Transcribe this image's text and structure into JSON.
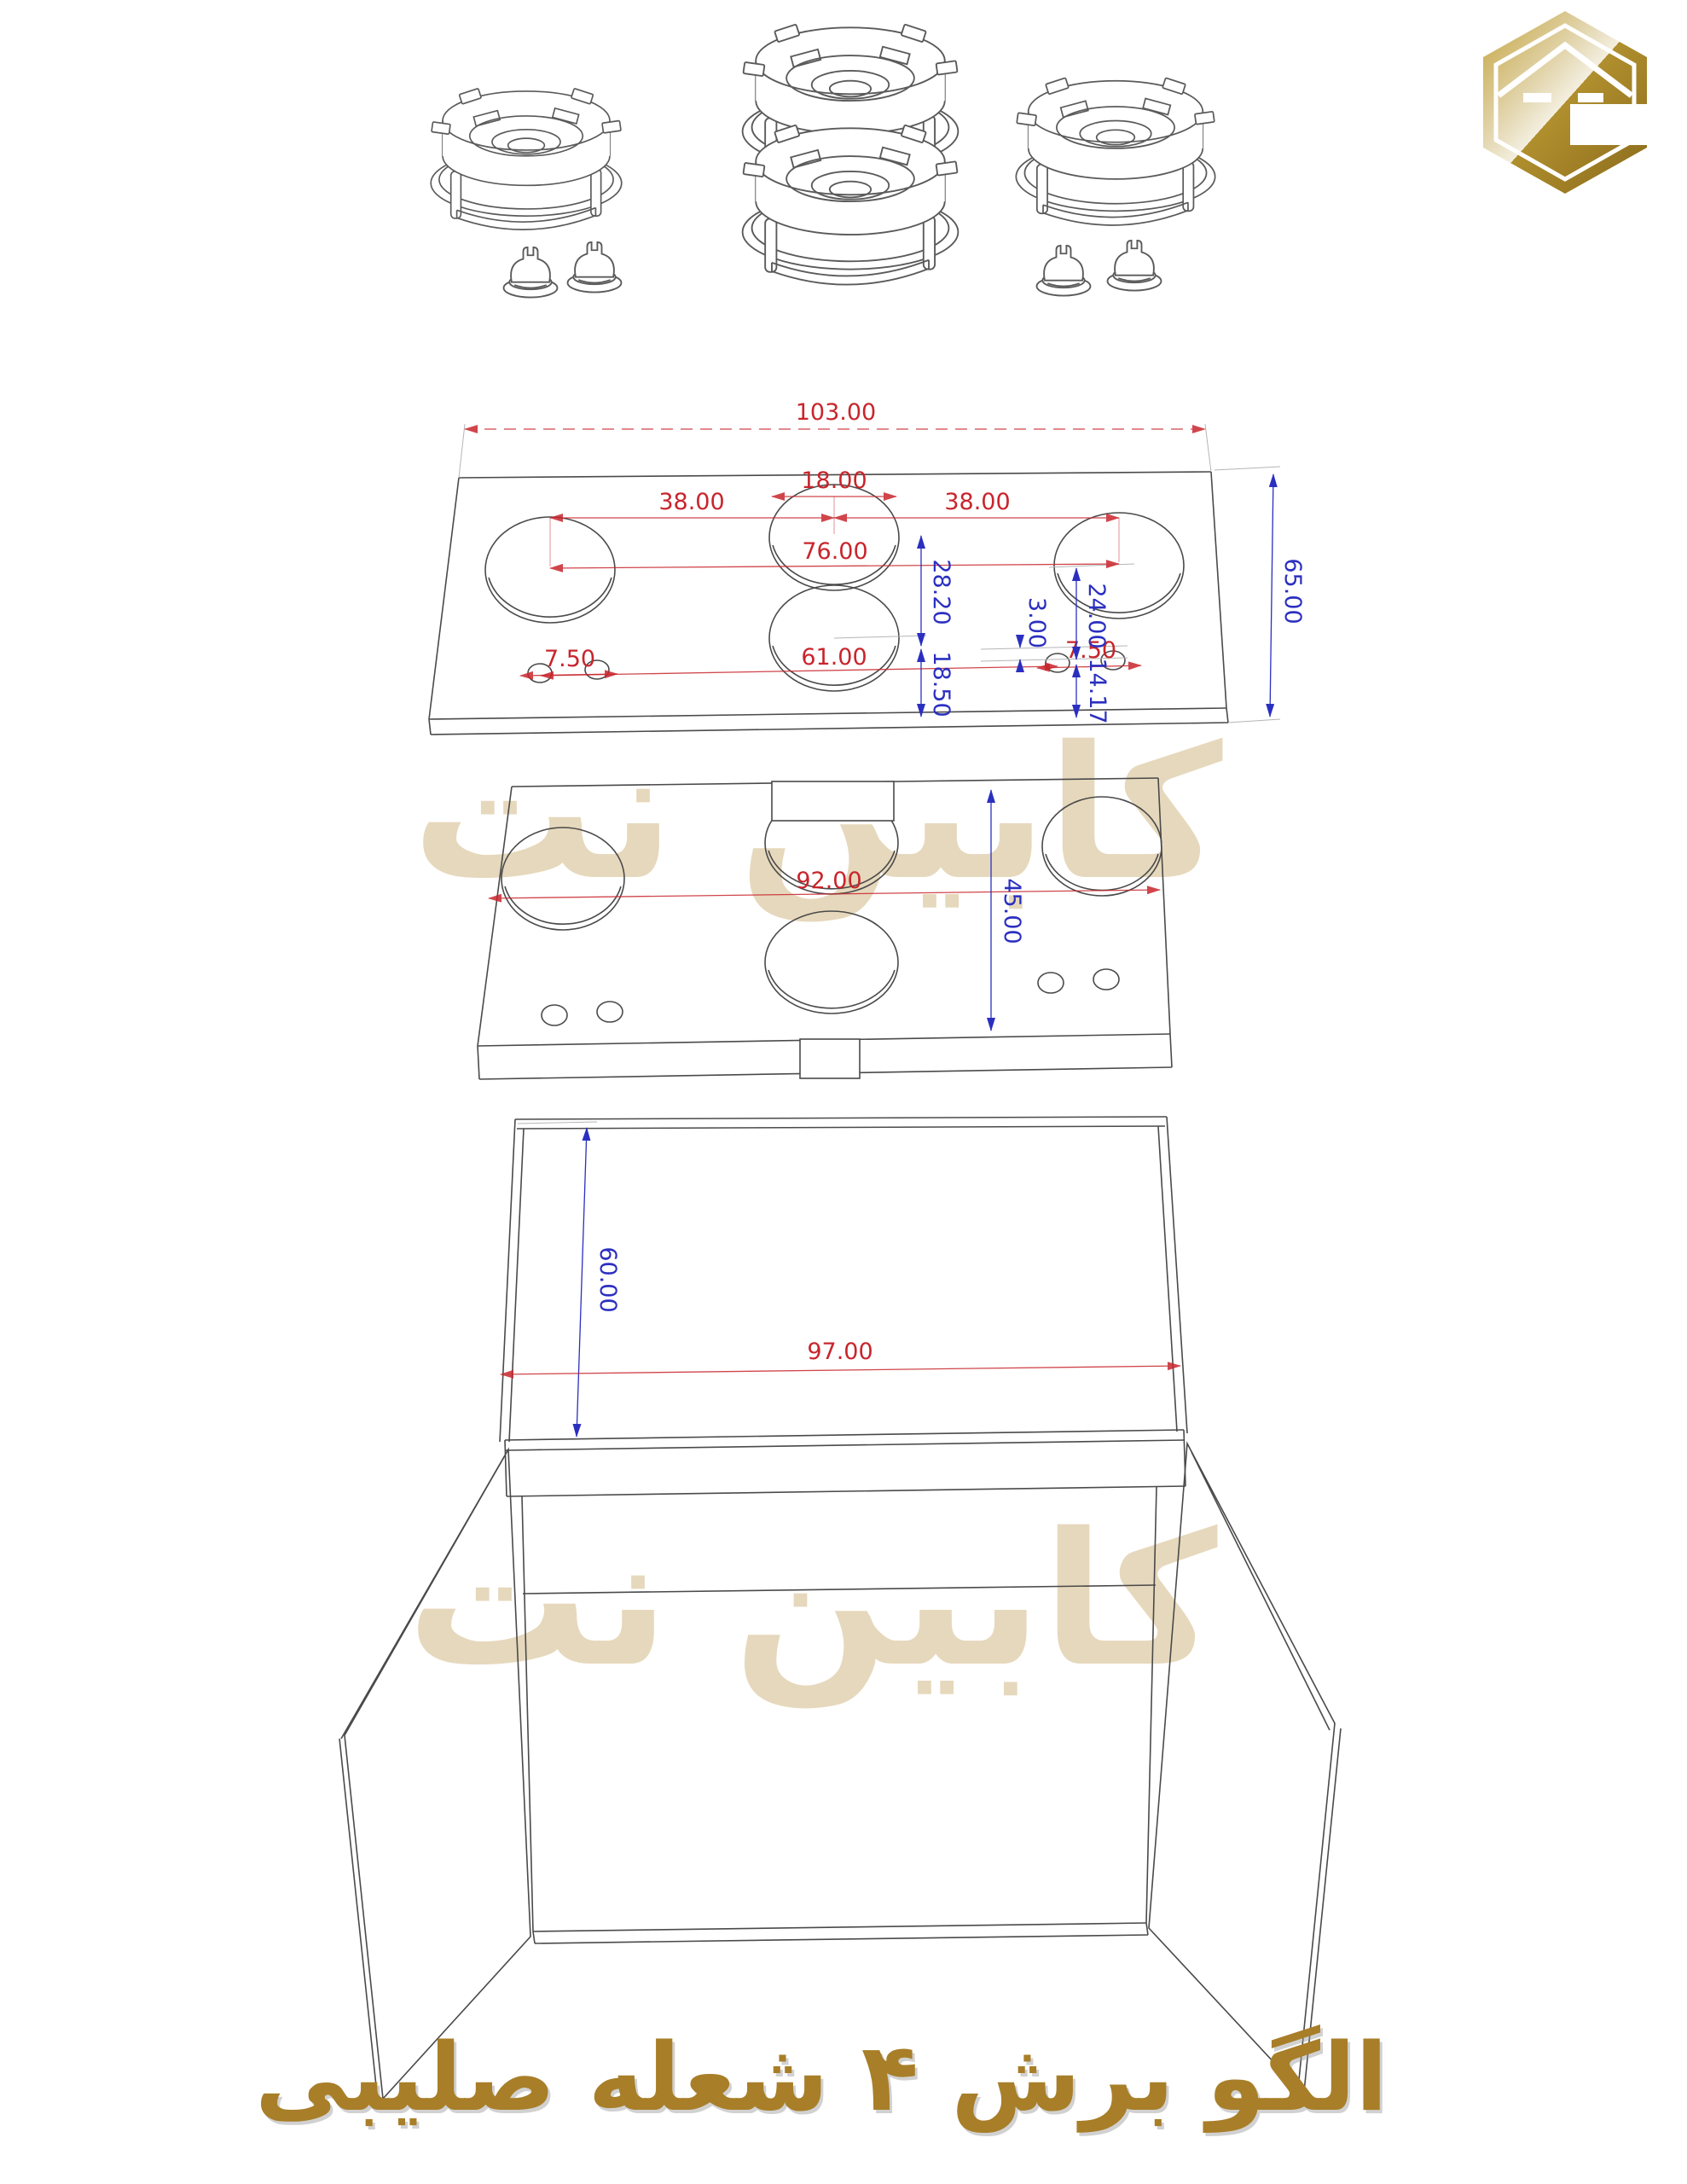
{
  "title": {
    "text": "الگو برش ۴ شعله صلیبی",
    "color": "#A87E28"
  },
  "watermark": {
    "text": "کابین نت",
    "color": "#E6D8BC"
  },
  "logo": {
    "gold_light": "#C6A43C",
    "gold_dark": "#8A691B"
  },
  "colors": {
    "dimension_red": "#C8252C",
    "dimension_blue": "#2B2FC0",
    "drawing_line": "#4A4A4A"
  },
  "top_plate": {
    "dimensions": {
      "overall_width": "103.00",
      "center_hole_diameter": "18.00",
      "left_spacing": "38.00",
      "right_spacing": "38.00",
      "outer_centers_span": "76.00",
      "overall_depth": "65.00",
      "center_holes_gap": "28.20",
      "right_hole_offset": "24.00",
      "ignitor_row_offset": "3.00",
      "left_ignitor_spacing": "7.50",
      "ignitor_span": "61.00",
      "right_ignitor_spacing": "7.50",
      "front_offset": "18.50",
      "ignitor_front_offset": "14.17"
    }
  },
  "lower_plate": {
    "dimensions": {
      "width": "92.00",
      "depth": "45.00"
    }
  },
  "cabinet": {
    "dimensions": {
      "height": "60.00",
      "width": "97.00"
    }
  }
}
